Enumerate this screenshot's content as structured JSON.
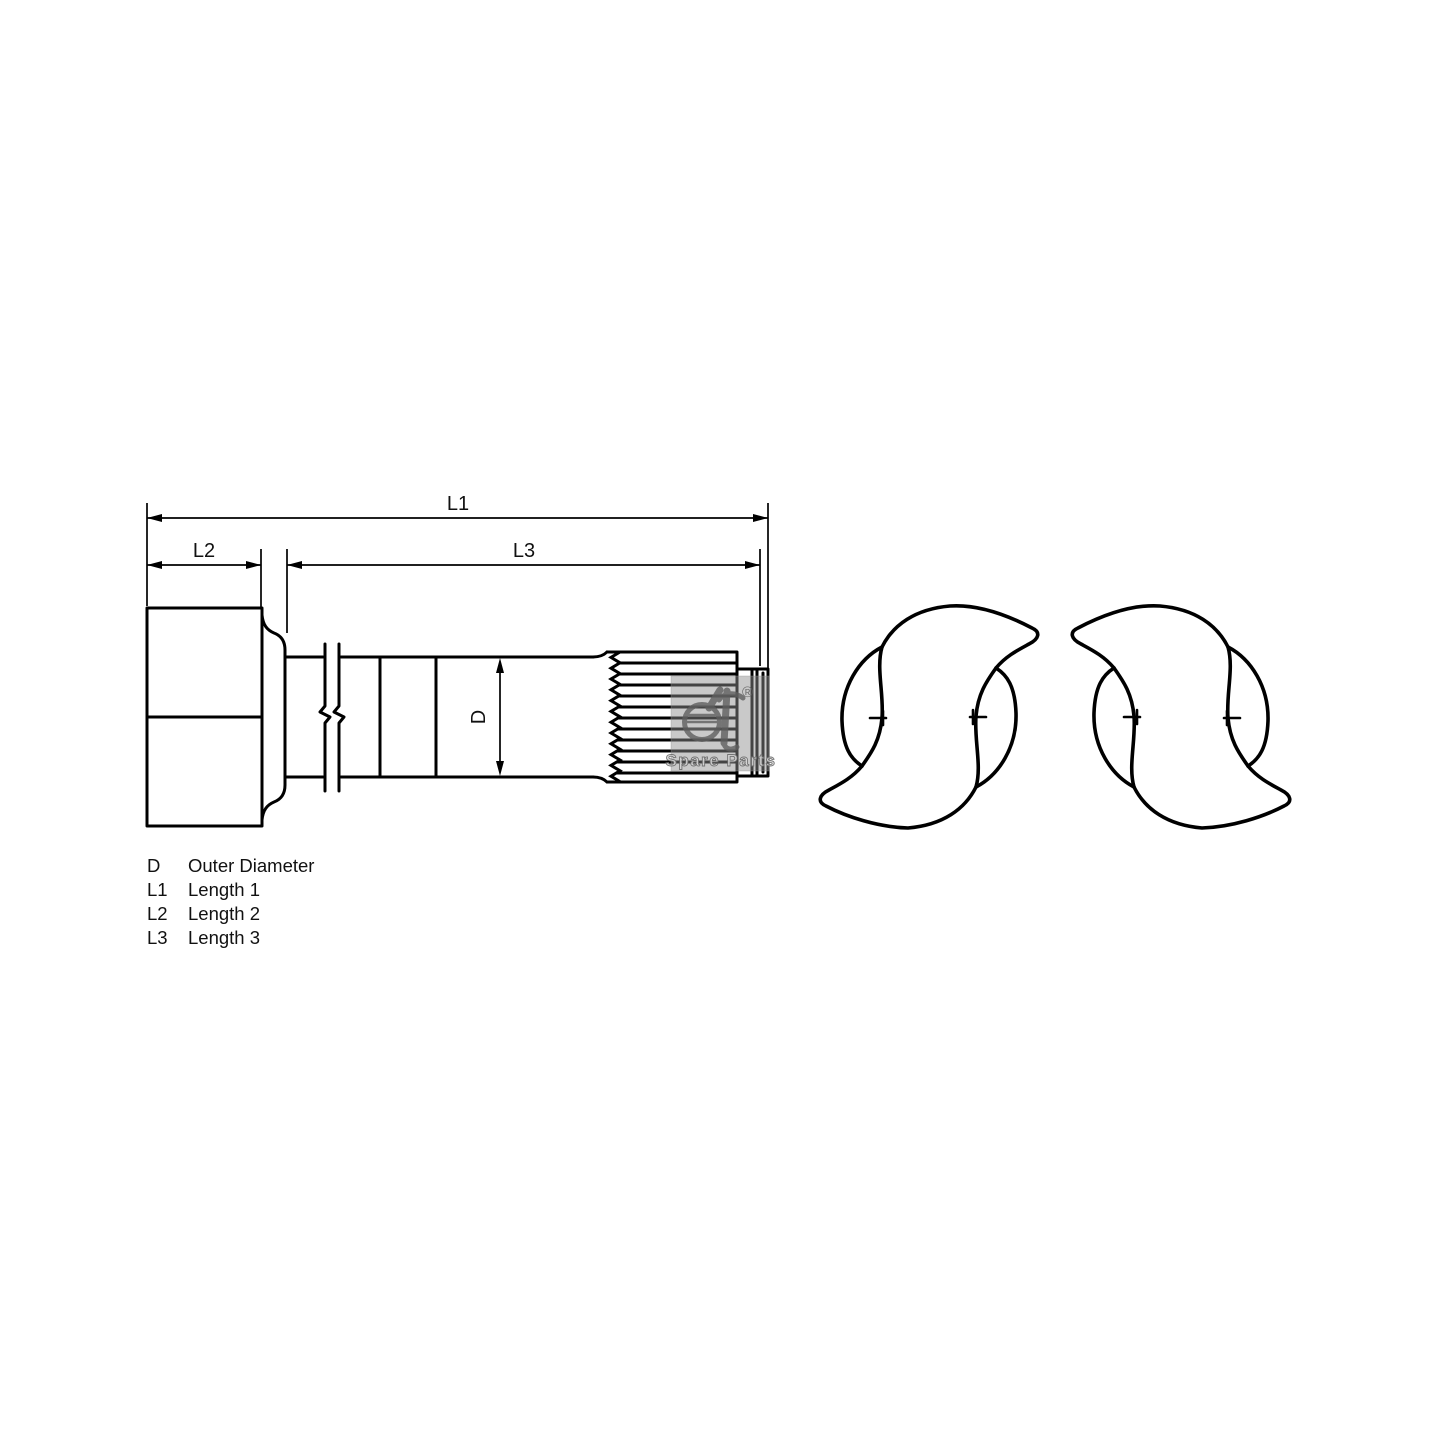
{
  "dimensions": {
    "l1": "L1",
    "l2": "L2",
    "l3": "L3",
    "d": "D"
  },
  "legend": {
    "rows": [
      {
        "symbol": "D",
        "meaning": "Outer Diameter"
      },
      {
        "symbol": "L1",
        "meaning": "Length 1"
      },
      {
        "symbol": "L2",
        "meaning": "Length 2"
      },
      {
        "symbol": "L3",
        "meaning": "Length 3"
      }
    ]
  },
  "watermark": {
    "logo": "dt",
    "registered": "®",
    "caption": "Spare Parts"
  },
  "colors": {
    "line": "#000000",
    "background": "#ffffff",
    "watermark": "#8f8f8f"
  }
}
